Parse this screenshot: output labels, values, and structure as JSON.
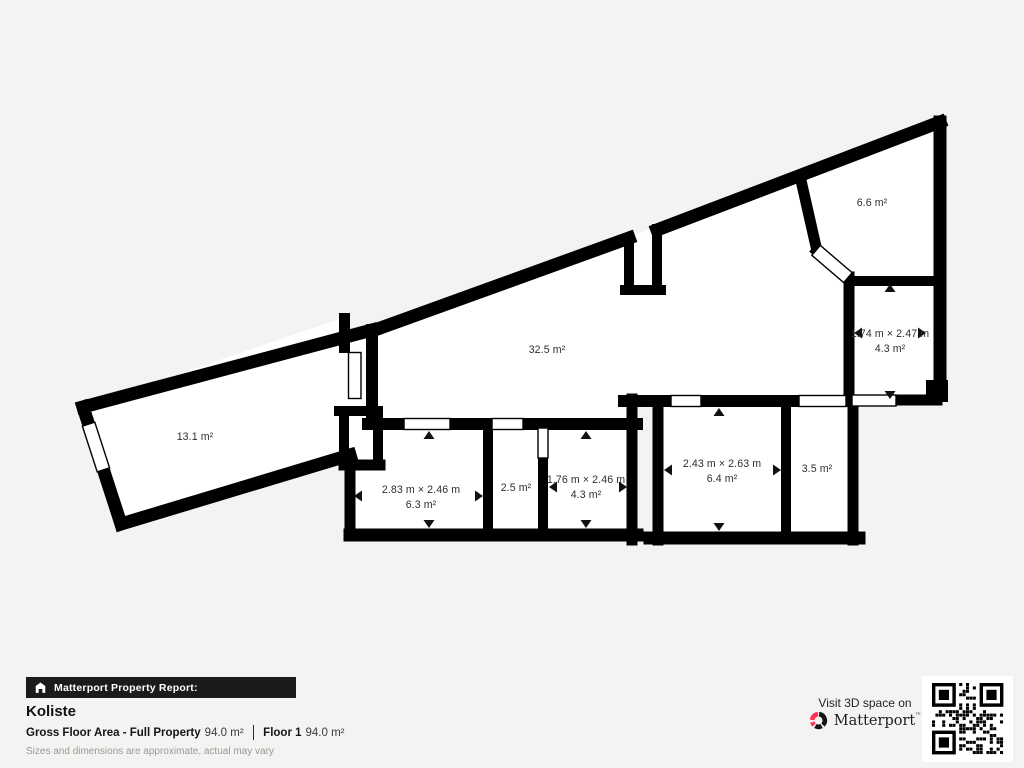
{
  "colors": {
    "background": "#f4f3f1",
    "wall": "#000000",
    "room_fill": "#ffffff",
    "badge_bg": "#1b1b1b",
    "brand_red": "#ff3158"
  },
  "plan": {
    "rooms": [
      {
        "id": "top-right-room",
        "area": "6.6 m²"
      },
      {
        "id": "right-room",
        "dimensions": "1.74 m × 2.47 m",
        "area": "4.3 m²"
      },
      {
        "id": "main-room",
        "area": "32.5 m²"
      },
      {
        "id": "left-room",
        "area": "13.1 m²"
      },
      {
        "id": "bottom-room-1",
        "dimensions": "2.83 m × 2.46 m",
        "area": "6.3 m²"
      },
      {
        "id": "bottom-room-2",
        "area": "2.5 m²"
      },
      {
        "id": "bottom-room-3",
        "dimensions": "1.76 m × 2.46 m",
        "area": "4.3 m²"
      },
      {
        "id": "bottom-room-4",
        "dimensions": "2.43 m × 2.63 m",
        "area": "6.4 m²"
      },
      {
        "id": "bottom-room-5",
        "area": "3.5 m²"
      }
    ]
  },
  "footer": {
    "badge_label": "Matterport Property Report:",
    "property_name": "Koliste",
    "gross_floor_area_label": "Gross Floor Area - Full Property",
    "gross_floor_area_value": "94.0 m²",
    "floor_label": "Floor 1",
    "floor_value": "94.0 m²",
    "disclaimer": "Sizes and dimensions are approximate, actual may vary"
  },
  "cta": {
    "visit_text": "Visit 3D space on",
    "brand_name": "Matterport",
    "trademark": "™"
  }
}
